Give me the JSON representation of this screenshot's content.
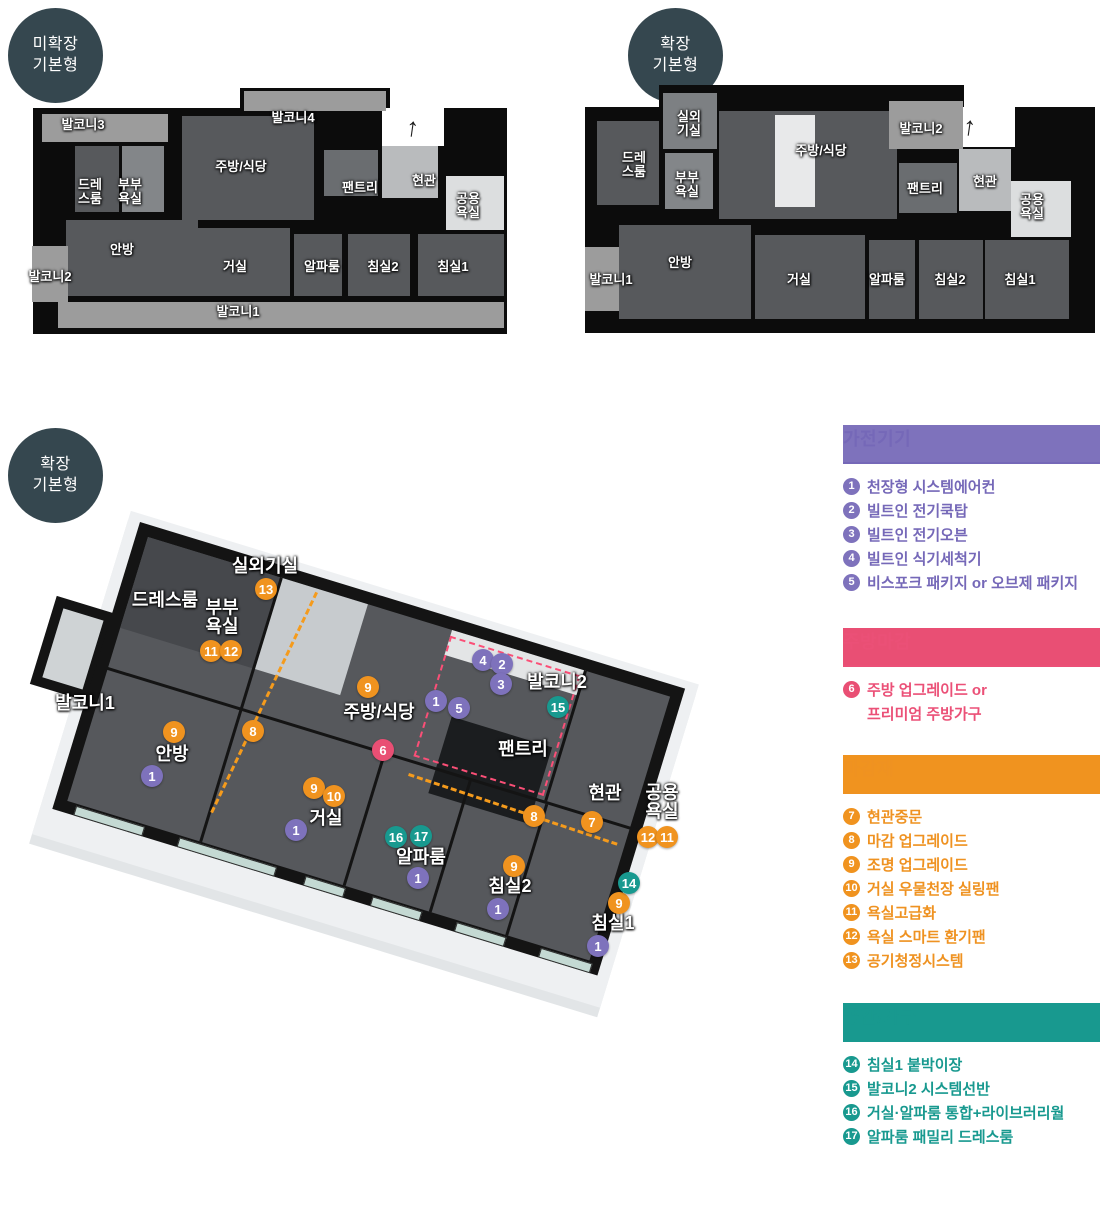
{
  "badges": {
    "plan_a": {
      "line1": "미확장",
      "line2": "기본형"
    },
    "plan_b": {
      "line1": "확장",
      "line2": "기본형"
    },
    "plan_iso": {
      "line1": "확장",
      "line2": "기본형"
    }
  },
  "plan_a": {
    "labels": [
      "발코니3",
      "발코니4",
      "드레스룸",
      "부부욕실",
      "주방/식당",
      "팬트리",
      "현관",
      "공용욕실",
      "안방",
      "거실",
      "알파룸",
      "침실2",
      "침실1",
      "발코니2",
      "발코니1"
    ],
    "entrance_arrow": "↑"
  },
  "plan_b": {
    "labels": [
      "실외기실",
      "드레스룸",
      "부부욕실",
      "주방/식당",
      "발코니2",
      "팬트리",
      "현관",
      "공용욕실",
      "안방",
      "거실",
      "알파룸",
      "침실2",
      "침실1",
      "발코니1"
    ],
    "entrance_arrow": "↑"
  },
  "plan_iso": {
    "labels": [
      "실외기실",
      "드레스룸",
      "부부욕실",
      "발코니1",
      "안방",
      "주방/식당",
      "발코니2",
      "팬트리",
      "현관",
      "공용욕실",
      "거실",
      "알파룸",
      "침실2",
      "침실1"
    ],
    "markers": [
      {
        "n": "4"
      },
      {
        "n": "2"
      },
      {
        "n": "3"
      },
      {
        "n": "1"
      },
      {
        "n": "5"
      },
      {
        "n": "1"
      },
      {
        "n": "1"
      },
      {
        "n": "1"
      },
      {
        "n": "1"
      },
      {
        "n": "1"
      },
      {
        "n": "6"
      },
      {
        "n": "7"
      },
      {
        "n": "8"
      },
      {
        "n": "8"
      },
      {
        "n": "9"
      },
      {
        "n": "9"
      },
      {
        "n": "9"
      },
      {
        "n": "10"
      },
      {
        "n": "9"
      },
      {
        "n": "9"
      },
      {
        "n": "11"
      },
      {
        "n": "12"
      },
      {
        "n": "12"
      },
      {
        "n": "11"
      },
      {
        "n": "13"
      },
      {
        "n": "14"
      },
      {
        "n": "15"
      },
      {
        "n": "16"
      },
      {
        "n": "17"
      }
    ]
  },
  "legend": {
    "sections": [
      {
        "title": "가전기기",
        "color": "#7568b8",
        "items": [
          {
            "n": "1",
            "t": "천장형 시스템에어컨"
          },
          {
            "n": "2",
            "t": "빌트인 전기쿡탑"
          },
          {
            "n": "3",
            "t": "빌트인 전기오븐"
          },
          {
            "n": "4",
            "t": "빌트인 식기세척기"
          },
          {
            "n": "5",
            "t": "비스포크 패키지 or 오브제 패키지"
          }
        ]
      },
      {
        "title": "주방마감",
        "color": "#eb5077",
        "items": [
          {
            "n": "6",
            "t": "주방 업그레이드 or"
          },
          {
            "n": "",
            "t": "프리미엄 주방가구"
          }
        ]
      },
      {
        "title": "마감재",
        "color": "#ef9221",
        "items": [
          {
            "n": "7",
            "t": "현관중문"
          },
          {
            "n": "8",
            "t": "마감 업그레이드"
          },
          {
            "n": "9",
            "t": "조명 업그레이드"
          },
          {
            "n": "10",
            "t": "거실 우물천장 실링팬"
          },
          {
            "n": "11",
            "t": "욕실고급화"
          },
          {
            "n": "12",
            "t": "욕실 스마트 환기팬"
          },
          {
            "n": "13",
            "t": "공기청정시스템"
          }
        ]
      },
      {
        "title": "공간/가구",
        "color": "#18998f",
        "items": [
          {
            "n": "14",
            "t": "침실1 붙박이장"
          },
          {
            "n": "15",
            "t": "발코니2 시스템선반"
          },
          {
            "n": "16",
            "t": "거실·알파룸 통합+라이브러리월"
          },
          {
            "n": "17",
            "t": "알파룸 패밀리 드레스룸"
          }
        ]
      }
    ]
  },
  "colors": {
    "badge_bg": "#35474f",
    "appliance_purple": "#7e72bc",
    "kitchen_pink": "#e94f74",
    "finish_orange": "#f0931f",
    "space_teal": "#18998f",
    "wall_black": "#141414",
    "wood_floor": "#57595c",
    "balcony_tile": "#9c9c9c",
    "dash_pink": "#fb4f77",
    "dash_orange": "#f59b1c"
  }
}
